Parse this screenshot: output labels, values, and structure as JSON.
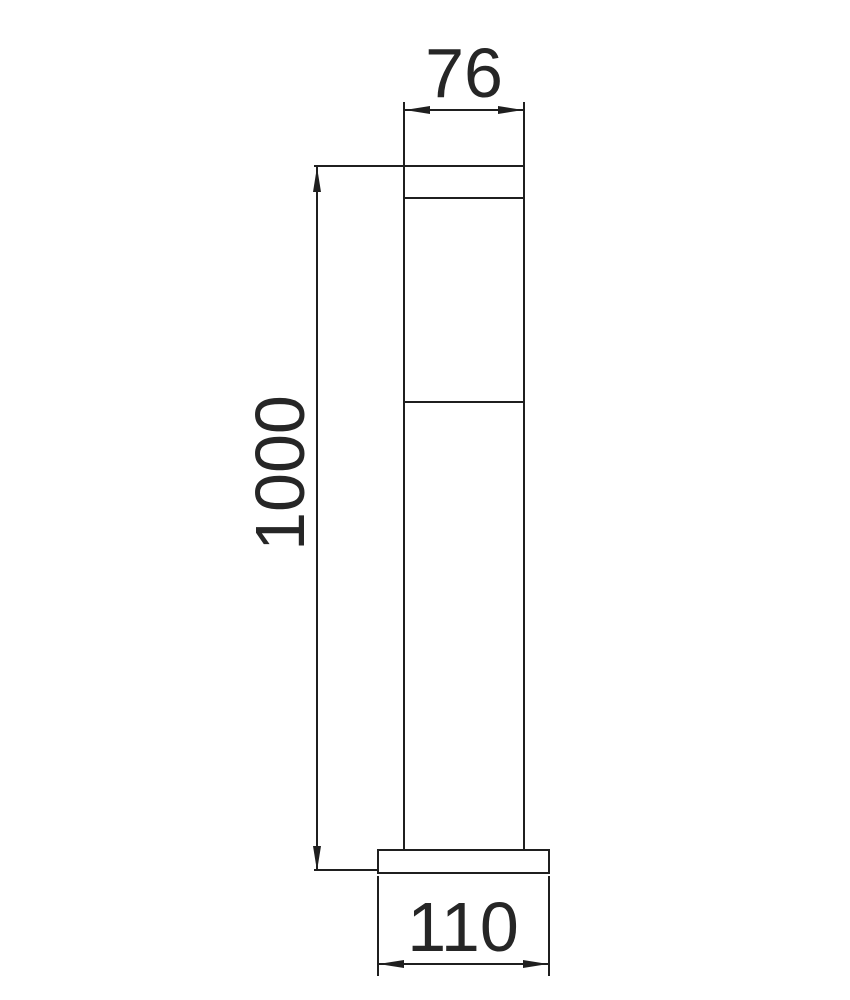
{
  "figure": {
    "background_color": "#ffffff",
    "line_color": "#1f1f1f",
    "text_color": "#262626"
  },
  "dimensions": {
    "top_width": "76",
    "height": "1000",
    "base_width": "110"
  }
}
